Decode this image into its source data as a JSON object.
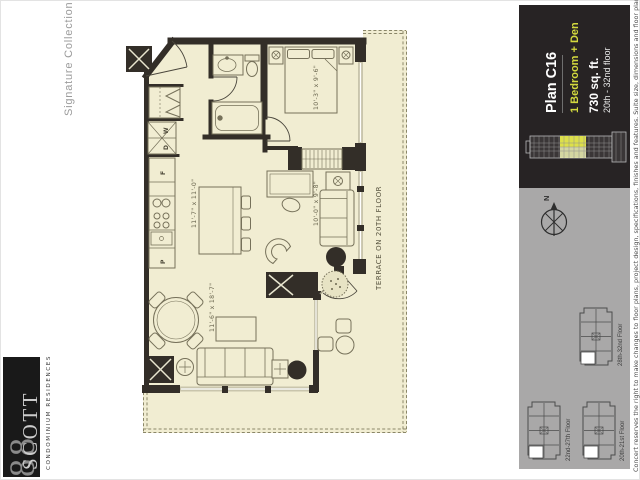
{
  "branding": {
    "collection": "Signature Collection",
    "logo_number": "88",
    "logo_name": "SCOTT",
    "logo_tagline": "CONDOMINIUM RESIDENCES"
  },
  "panel": {
    "plan_name": "Plan C16",
    "plan_type": "1 Bedroom + Den",
    "area": "730 sq. ft.",
    "floors": "20th - 32nd floor"
  },
  "plan": {
    "terrace_label": "TERRACE ON 20TH FLOOR",
    "dims": {
      "bedroom": "10'-3\" x 9'-6\"",
      "kitchen": "11'-7\" x 11'-0\"",
      "living": "11'-6\" x 18'-7\"",
      "den": "10'-0\" x 9'-8\""
    },
    "fixtures": {
      "washer": "W",
      "dryer": "D",
      "fridge": "F",
      "pantry": "P"
    }
  },
  "compass": {
    "north": "N"
  },
  "keyplans": [
    {
      "label": "28th-32nd Floor"
    },
    {
      "label": "22nd-27th Floor"
    },
    {
      "label": "20th-21st Floor"
    }
  ],
  "disclaimer": "Concert reserves the right to make changes to floor plans, project design, specifications, finishes and features. Suite size, dimensions and floor plan layouts may vary. April 2012.",
  "colors": {
    "accent": "#d3d93e",
    "panel": "#272324",
    "gray_panel": "#a9a8a8",
    "plan_fill": "#f1edd2",
    "wall": "#332e28"
  }
}
